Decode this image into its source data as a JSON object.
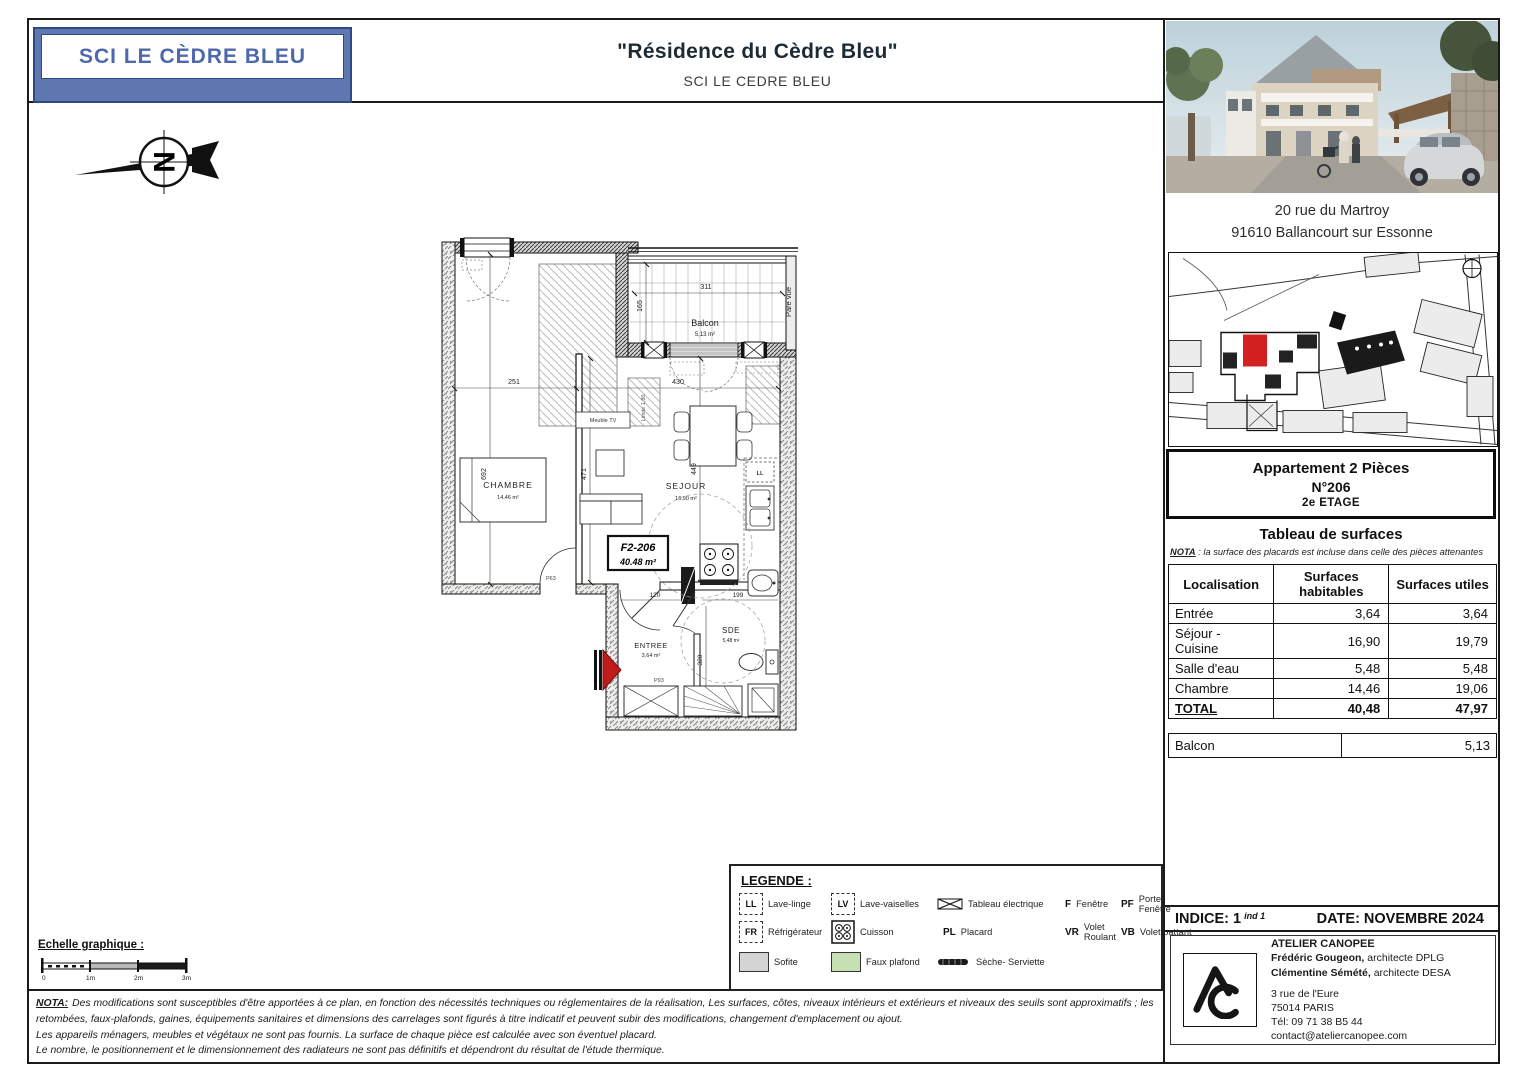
{
  "logo": {
    "text": "SCI LE CÈDRE BLEU"
  },
  "header": {
    "title": "\"Résidence du Cèdre Bleu\"",
    "subtitle": "SCI LE CEDRE BLEU"
  },
  "right_panel": {
    "address_line1": "20 rue du Martroy",
    "address_line2": "91610 Ballancourt sur Essonne",
    "apartment": {
      "line1": "Appartement 2 Pièces",
      "line2": "N°206",
      "line3": "2e ETAGE"
    },
    "surface_table": {
      "title": "Tableau de surfaces",
      "nota_label": "NOTA",
      "nota_text": " : la surface des placards est incluse dans celle des pièces attenantes",
      "columns": [
        "Localisation",
        "Surfaces habitables",
        "Surfaces utiles"
      ],
      "rows": [
        [
          "Entrée",
          "3,64",
          "3,64"
        ],
        [
          "Séjour - Cuisine",
          "16,90",
          "19,79"
        ],
        [
          "Salle d'eau",
          "5,48",
          "5,48"
        ],
        [
          "Chambre",
          "14,46",
          "19,06"
        ]
      ],
      "total": [
        "TOTAL",
        "40,48",
        "47,97"
      ],
      "balcon_row": [
        "Balcon",
        "5,13"
      ]
    },
    "indice_label": "INDICE:",
    "indice_value": "1",
    "indice_suffix": "ind 1",
    "date": "DATE: NOVEMBRE 2024",
    "architect": {
      "name": "ATELIER CANOPEE",
      "line1_name": "Frédéric Gougeon,",
      "line1_role": " architecte DPLG",
      "line2_name": "Clémentine Sémété,",
      "line2_role": " architecte DESA",
      "address1": "3 rue de l'Eure",
      "address2": "75014 PARIS",
      "phone": "Tél: 09 71 38 B5 44",
      "email": "contact@ateliercanopee.com"
    }
  },
  "plan": {
    "unit_code": "F2-206",
    "unit_area": "40.48 m²",
    "compass_letter": "N",
    "rooms": {
      "chambre": {
        "name": "CHAMBRE",
        "area": "14,46 m²"
      },
      "sejour": {
        "name": "SEJOUR",
        "area": "16,90 m²"
      },
      "entree": {
        "name": "ENTREE",
        "area": "3,64 m²"
      },
      "sde": {
        "name": "SDE",
        "area": "5,48 m²"
      },
      "balcon": {
        "name": "Balcon",
        "area": "5,13 m²"
      }
    },
    "dims": {
      "chambre_w": "251",
      "chambre_h": "692",
      "sejour_w": "430",
      "sejour_h": "449",
      "sejour_h2": "471",
      "balcon_w": "311",
      "balcon_h": "165",
      "entree_w": "120",
      "sde_w": "199",
      "sde_h": "320"
    },
    "labels": {
      "meuble_tv": "Meuble TV",
      "pare_vue": "Pare vue",
      "limite": "Limite 1,80",
      "door_chambre": "P63",
      "door_entree": "P93",
      "ll": "LL"
    }
  },
  "legend": {
    "title": "LEGENDE :",
    "row1": [
      {
        "k": "LL",
        "label": "Lave-linge"
      },
      {
        "k": "LV",
        "label": "Lave-vaiselles"
      },
      {
        "k": "",
        "label": "Tableau électrique"
      },
      {
        "k": "F",
        "label": "Fenêtre"
      },
      {
        "k": "PF",
        "label": "Porte-Fenêtre"
      }
    ],
    "row2": [
      {
        "k": "FR",
        "label": "Réfrigérateur"
      },
      {
        "k": "",
        "label": "Cuisson"
      },
      {
        "k": "PL",
        "label": "Placard"
      },
      {
        "k": "VR",
        "label": "Volet Roulant"
      },
      {
        "k": "VB",
        "label": "Volet battant"
      }
    ],
    "row3": [
      {
        "label": "Sofite"
      },
      {
        "label": "Faux plafond"
      },
      {
        "label": "Sèche- Serviette"
      }
    ]
  },
  "scale": {
    "title": "Echelle graphique :",
    "ticks": [
      "0",
      "1m",
      "2m",
      "3m"
    ]
  },
  "nota": {
    "label": "NOTA:",
    "line1": "Des modifications sont susceptibles d'être apportées à ce plan, en fonction des nécessités techniques ou réglementaires de la réalisation, Les surfaces, côtes, niveaux intérieurs et extérieurs et niveaux des seuils sont approximatifs ; les",
    "line2": "retombées, faux-plafonds, gaines, équipements sanitaires et dimensions des carrelages sont figurés à titre indicatif et peuvent subir des modifications, changement d'emplacement ou ajout.",
    "line3": "Les appareils ménagers, meubles et végétaux ne sont pas fournis. La surface de chaque pièce est calculée avec son éventuel placard.",
    "line4": "Le nombre, le positionnement et le dimensionnement des radiateurs ne sont pas définitifs et dépendront du résultat de l'étude thermique."
  },
  "colors": {
    "logo_blue": "#6078b2",
    "logo_border": "#2e4a84",
    "logo_text": "#4d68ab",
    "faux_plafond_green": "#c6e0b4",
    "sofite_gray": "#d4d4d4",
    "unit_red": "#d32020",
    "entry_arrow_red": "#bf1b1b"
  }
}
